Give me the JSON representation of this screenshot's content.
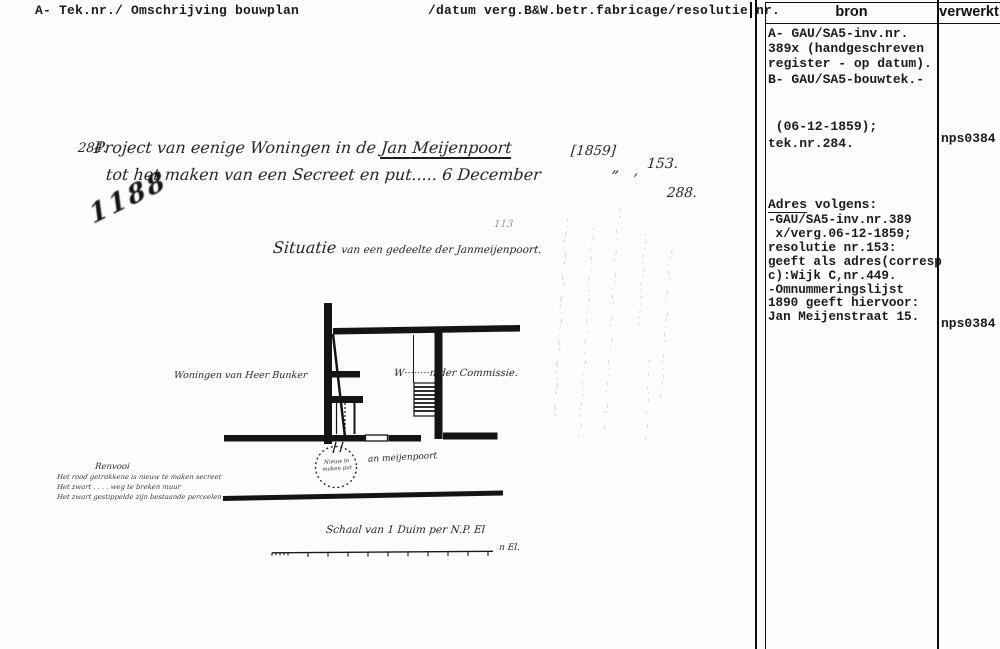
{
  "header": {
    "left": "A- Tek.nr./ Omschrijving bouwplan",
    "middle": "/datum verg.B&W.betr.fabricage/resolutie nr.",
    "bron_label": "bron",
    "verwerkt_label": "verwerkt"
  },
  "bron": {
    "lines_a": [
      "A- GAU/SA5-inv.nr.",
      "389x (handgeschreven",
      "register - op datum).",
      "B- GAU/SA5-bouwtek.-"
    ],
    "lines_b": [
      " (06-12-1859);",
      "tek.nr.284."
    ],
    "adres_head_u": "Adres",
    "adres_head_rest": " volgens:",
    "adres_lines": [
      "-GAU/SA5-inv.nr.389",
      " x/verg.06-12-1859;",
      "resolutie nr.153:",
      "geeft als adres(corresp",
      "c):Wijk C,nr.449.",
      "-Omnummeringslijst",
      "1890 geeft hiervoor:",
      "Jan Meijenstraat 15."
    ]
  },
  "verwerkt": {
    "stamp1": "nps0384",
    "stamp2": "nps0384"
  },
  "manuscript": {
    "number_left": "284.",
    "line1_pre": "Project van eenige Woningen in de ",
    "line1_underlined": "Jan Meijenpoort",
    "line2": "tot het maken van een Secreet en put..... 6 December",
    "year": "[1859]",
    "ditto_mark": "„",
    "comma": ",",
    "resolutie_nr": "153.",
    "second_number": "288.",
    "scribble_number": "1188",
    "pencil_note": "113",
    "title_main": "Situatie",
    "title_rest": "van een gedeelte der Janmeijenpoort.",
    "label_left": "Woningen van Heer Bunker",
    "label_right": "W········n der Commissie.",
    "circle_line1": "Nieuw te",
    "circle_line2": "maken put",
    "circle_note": "an meijenpoort",
    "legend_title": "Renvooi",
    "legend_line1": "Het rood getrokkene is nieuw te maken secreet",
    "legend_line2": "Het zwart . . . . weg te breken muur",
    "legend_line3": "Het zwart gestippelde zijn bestaande perceelen",
    "scale_caption": "Schaal van 1 Duim per N.P. El",
    "scale_end_label": "n El."
  }
}
